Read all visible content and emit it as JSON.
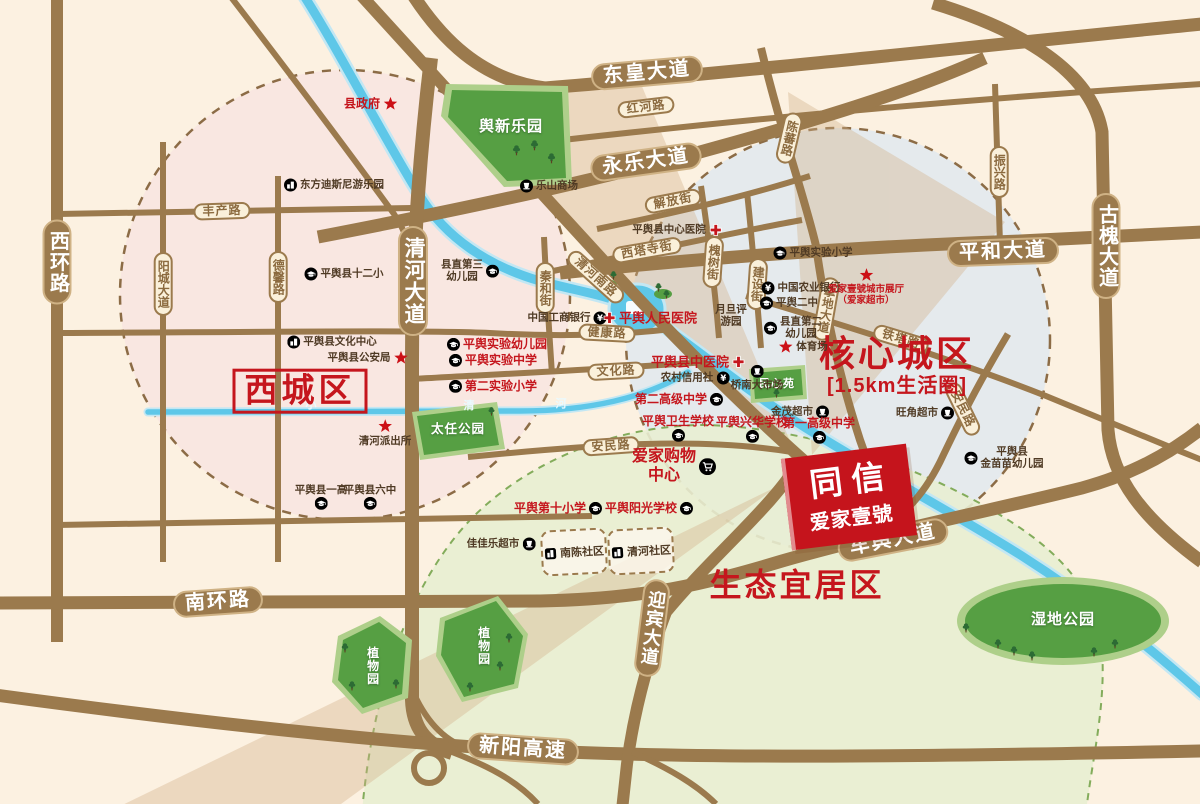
{
  "palette": {
    "background": "#fcf1e1",
    "road_brown": "#9b7a4d",
    "road_capsule_border": "#cfb285",
    "minor_capsule_bg": "#faf0da",
    "minor_capsule_text": "#8b6a3f",
    "river_blue": "#5ec7e8",
    "park_green_dark": "#569f43",
    "park_green_light": "#aecf8a",
    "accent_red": "#c5161d",
    "poi_brown_text": "#4f3a24",
    "west_circle_fill": "#f6dee2",
    "core_circle_fill": "#dfe9f0",
    "eco_zone_fill": "#e8eed2",
    "wedge_tan": "#d2b189"
  },
  "project": {
    "line1": "同信",
    "line2": "爱家壹號"
  },
  "districts": [
    {
      "label": "西城区",
      "x": 300,
      "y": 391,
      "size": 33,
      "boxed": true
    },
    {
      "label": "核心城区",
      "sub": "[1.5km生活圈]",
      "x": 897,
      "y": 366,
      "size": 36
    },
    {
      "label": "生态宜居区",
      "x": 797,
      "y": 586,
      "size": 32
    }
  ],
  "roads": {
    "major": [
      {
        "label": "东皇大道",
        "x": 647,
        "y": 73,
        "rot": -5
      },
      {
        "label": "永乐大道",
        "x": 646,
        "y": 162,
        "rot": -8
      },
      {
        "label": "平和大道",
        "x": 1003,
        "y": 252,
        "rot": -2
      },
      {
        "label": "古槐大道",
        "x": 1106,
        "y": 246,
        "vertical": true
      },
      {
        "label": "西环路",
        "x": 57,
        "y": 262,
        "vertical": true
      },
      {
        "label": "清河大道",
        "x": 413,
        "y": 281,
        "vertical": true,
        "size": 21
      },
      {
        "label": "南环路",
        "x": 218,
        "y": 602,
        "rot": -4
      },
      {
        "label": "车舆大道",
        "x": 893,
        "y": 540,
        "rot": -11
      },
      {
        "label": "迎宾大道",
        "x": 652,
        "y": 628,
        "vertical": true,
        "rot": 7,
        "size": 18
      },
      {
        "label": "新阳高速",
        "x": 523,
        "y": 749,
        "rot": 4
      }
    ],
    "minor": [
      {
        "label": "红河路",
        "x": 646,
        "y": 107,
        "rot": -7
      },
      {
        "label": "丰产路",
        "x": 222,
        "y": 211,
        "rot": -2
      },
      {
        "label": "阳城大道",
        "x": 163,
        "y": 284,
        "vertical": true
      },
      {
        "label": "德馨路",
        "x": 278,
        "y": 277,
        "vertical": true
      },
      {
        "label": "解放街",
        "x": 673,
        "y": 201,
        "rot": -11
      },
      {
        "label": "西塔寺街",
        "x": 647,
        "y": 250,
        "rot": -10
      },
      {
        "label": "槐树街",
        "x": 713,
        "y": 262,
        "vertical": true,
        "rot": 4
      },
      {
        "label": "建设街",
        "x": 757,
        "y": 284,
        "vertical": true,
        "rot": 4
      },
      {
        "label": "陈蕃路",
        "x": 789,
        "y": 138,
        "vertical": true,
        "rot": 13
      },
      {
        "label": "振兴路",
        "x": 999,
        "y": 172,
        "vertical": true
      },
      {
        "label": "挚地大道",
        "x": 826,
        "y": 309,
        "vertical": true,
        "rot": 10
      },
      {
        "label": "清河南路",
        "x": 596,
        "y": 277,
        "rot": 42
      },
      {
        "label": "秦和街",
        "x": 545,
        "y": 288,
        "vertical": true
      },
      {
        "label": "健康路",
        "x": 607,
        "y": 333,
        "rot": 3
      },
      {
        "label": "文化路",
        "x": 616,
        "y": 371,
        "rot": -3
      },
      {
        "label": "安民路",
        "x": 611,
        "y": 446,
        "rot": -4
      },
      {
        "label": "铁塔路",
        "x": 901,
        "y": 339,
        "rot": 17
      },
      {
        "label": "安民路",
        "x": 963,
        "y": 409,
        "rot": 64
      }
    ]
  },
  "river": {
    "name_chars": [
      {
        "ch": "小",
        "x": 311,
        "y": 404
      },
      {
        "ch": "清",
        "x": 469,
        "y": 405
      },
      {
        "ch": "河",
        "x": 561,
        "y": 403
      }
    ]
  },
  "parks": [
    {
      "label": "舆新乐园",
      "x": 511,
      "y": 127,
      "size": 15
    },
    {
      "label": "太任公园",
      "x": 458,
      "y": 430,
      "size": 12.5
    },
    {
      "label": "民心苑",
      "x": 777,
      "y": 384,
      "size": 11
    },
    {
      "label": "植物园",
      "x": 372,
      "y": 666,
      "size": 12,
      "vertical": true
    },
    {
      "label": "植物园",
      "x": 483,
      "y": 646,
      "size": 12,
      "vertical": true
    },
    {
      "label": "湿地公园",
      "x": 1063,
      "y": 620,
      "size": 15
    }
  ],
  "communities": [
    {
      "label": "南陈社区",
      "x": 574,
      "y": 552
    },
    {
      "label": "清河社区",
      "x": 641,
      "y": 551
    }
  ],
  "pois": [
    {
      "label": "东方迪斯尼游乐园",
      "x": 334,
      "y": 185,
      "icon": "bld",
      "side": "left",
      "color": "brown"
    },
    {
      "label": "乐山商场",
      "x": 549,
      "y": 186,
      "icon": "cup",
      "side": "left",
      "color": "brown"
    },
    {
      "label": "平舆县十二小",
      "x": 344,
      "y": 274,
      "icon": "cap",
      "side": "left",
      "color": "brown"
    },
    {
      "label": "县直第三\n幼儿园",
      "x": 470,
      "y": 271,
      "icon": "cap",
      "side": "right",
      "color": "brown"
    },
    {
      "label": "平舆县文化中心",
      "x": 332,
      "y": 342,
      "icon": "bld",
      "side": "left",
      "color": "brown"
    },
    {
      "label": "平舆县公安局",
      "x": 368,
      "y": 358,
      "icon": "star",
      "side": "right",
      "color": "brown"
    },
    {
      "label": "清河派出所",
      "x": 385,
      "y": 433,
      "icon": "star",
      "side": "above",
      "color": "brown"
    },
    {
      "label": "中国工商银行",
      "x": 567,
      "y": 318,
      "icon": "yuan",
      "side": "right",
      "color": "brown"
    },
    {
      "label": "中国农业银行",
      "x": 801,
      "y": 288,
      "icon": "yuan",
      "side": "left",
      "color": "brown"
    },
    {
      "label": "平舆二中",
      "x": 789,
      "y": 303,
      "icon": "cap",
      "side": "left",
      "color": "brown"
    },
    {
      "label": "县直第二\n幼儿园",
      "x": 793,
      "y": 328,
      "icon": "cap",
      "side": "left",
      "color": "brown"
    },
    {
      "label": "体育场",
      "x": 803,
      "y": 347,
      "icon": "star",
      "side": "left",
      "color": "brown"
    },
    {
      "label": "月旦评\n游园",
      "x": 731,
      "y": 316,
      "color": "brown"
    },
    {
      "label": "桥南大市场",
      "x": 757,
      "y": 378,
      "icon": "cup",
      "side": "above",
      "color": "brown"
    },
    {
      "label": "农村信用社",
      "x": 695,
      "y": 378,
      "icon": "yuan",
      "side": "right",
      "color": "brown"
    },
    {
      "label": "金茂超市",
      "x": 800,
      "y": 412,
      "icon": "cup",
      "side": "right",
      "color": "brown"
    },
    {
      "label": "旺角超市",
      "x": 925,
      "y": 413,
      "icon": "cup",
      "side": "right",
      "color": "brown"
    },
    {
      "label": "平舆县\n金苗苗幼儿园",
      "x": 1004,
      "y": 458,
      "icon": "cap",
      "side": "left",
      "color": "brown"
    },
    {
      "label": "佳佳乐超市",
      "x": 501,
      "y": 544,
      "icon": "cup",
      "side": "right",
      "color": "brown"
    },
    {
      "label": "平舆县一高",
      "x": 321,
      "y": 497,
      "icon": "cap",
      "side": "below",
      "color": "brown"
    },
    {
      "label": "平舆县六中",
      "x": 370,
      "y": 497,
      "icon": "cap",
      "side": "below",
      "color": "brown"
    },
    {
      "label": "平舆实验小学",
      "x": 813,
      "y": 253,
      "icon": "cap",
      "side": "left",
      "color": "brown"
    },
    {
      "label": "平舆县中心医院",
      "x": 677,
      "y": 230,
      "icon": "cross",
      "side": "right",
      "color": "brown"
    },
    {
      "label": "县政府",
      "x": 371,
      "y": 104,
      "icon": "star",
      "side": "right",
      "color": "red",
      "size": 12
    },
    {
      "label": "平舆实验幼儿园",
      "x": 497,
      "y": 344,
      "icon": "cap",
      "side": "left",
      "color": "red"
    },
    {
      "label": "平舆实验中学",
      "x": 493,
      "y": 360,
      "icon": "cap",
      "side": "left",
      "color": "red"
    },
    {
      "label": "第二实验小学",
      "x": 493,
      "y": 386,
      "icon": "cap",
      "side": "left",
      "color": "red"
    },
    {
      "label": "平舆人民医院",
      "x": 650,
      "y": 318,
      "icon": "cross",
      "side": "left",
      "color": "red",
      "size": 13
    },
    {
      "label": "平舆县中医院",
      "x": 698,
      "y": 362,
      "icon": "cross",
      "side": "right",
      "color": "red",
      "size": 13
    },
    {
      "label": "第二高级中学",
      "x": 679,
      "y": 399,
      "icon": "cap",
      "side": "right",
      "color": "red"
    },
    {
      "label": "平舆卫生学校",
      "x": 678,
      "y": 428,
      "icon": "cap",
      "side": "below",
      "color": "red"
    },
    {
      "label": "平舆兴华学校",
      "x": 752,
      "y": 429,
      "icon": "cap",
      "side": "below",
      "color": "red"
    },
    {
      "label": "第一高级中学",
      "x": 819,
      "y": 430,
      "icon": "cap",
      "side": "below",
      "color": "red"
    },
    {
      "label": "爱家购物\n中心",
      "x": 674,
      "y": 467,
      "icon": "cart",
      "side": "right",
      "color": "red",
      "size": 16
    },
    {
      "label": "平舆第十小学",
      "x": 558,
      "y": 508,
      "icon": "cap",
      "side": "right",
      "color": "red"
    },
    {
      "label": "平舆阳光学校",
      "x": 649,
      "y": 508,
      "icon": "cap",
      "side": "right",
      "color": "red"
    },
    {
      "label": "爱家壹號城市展厅\n（爱家超市）",
      "x": 866,
      "y": 287,
      "icon": "star",
      "side": "above",
      "color": "red",
      "size": 9.5
    }
  ]
}
